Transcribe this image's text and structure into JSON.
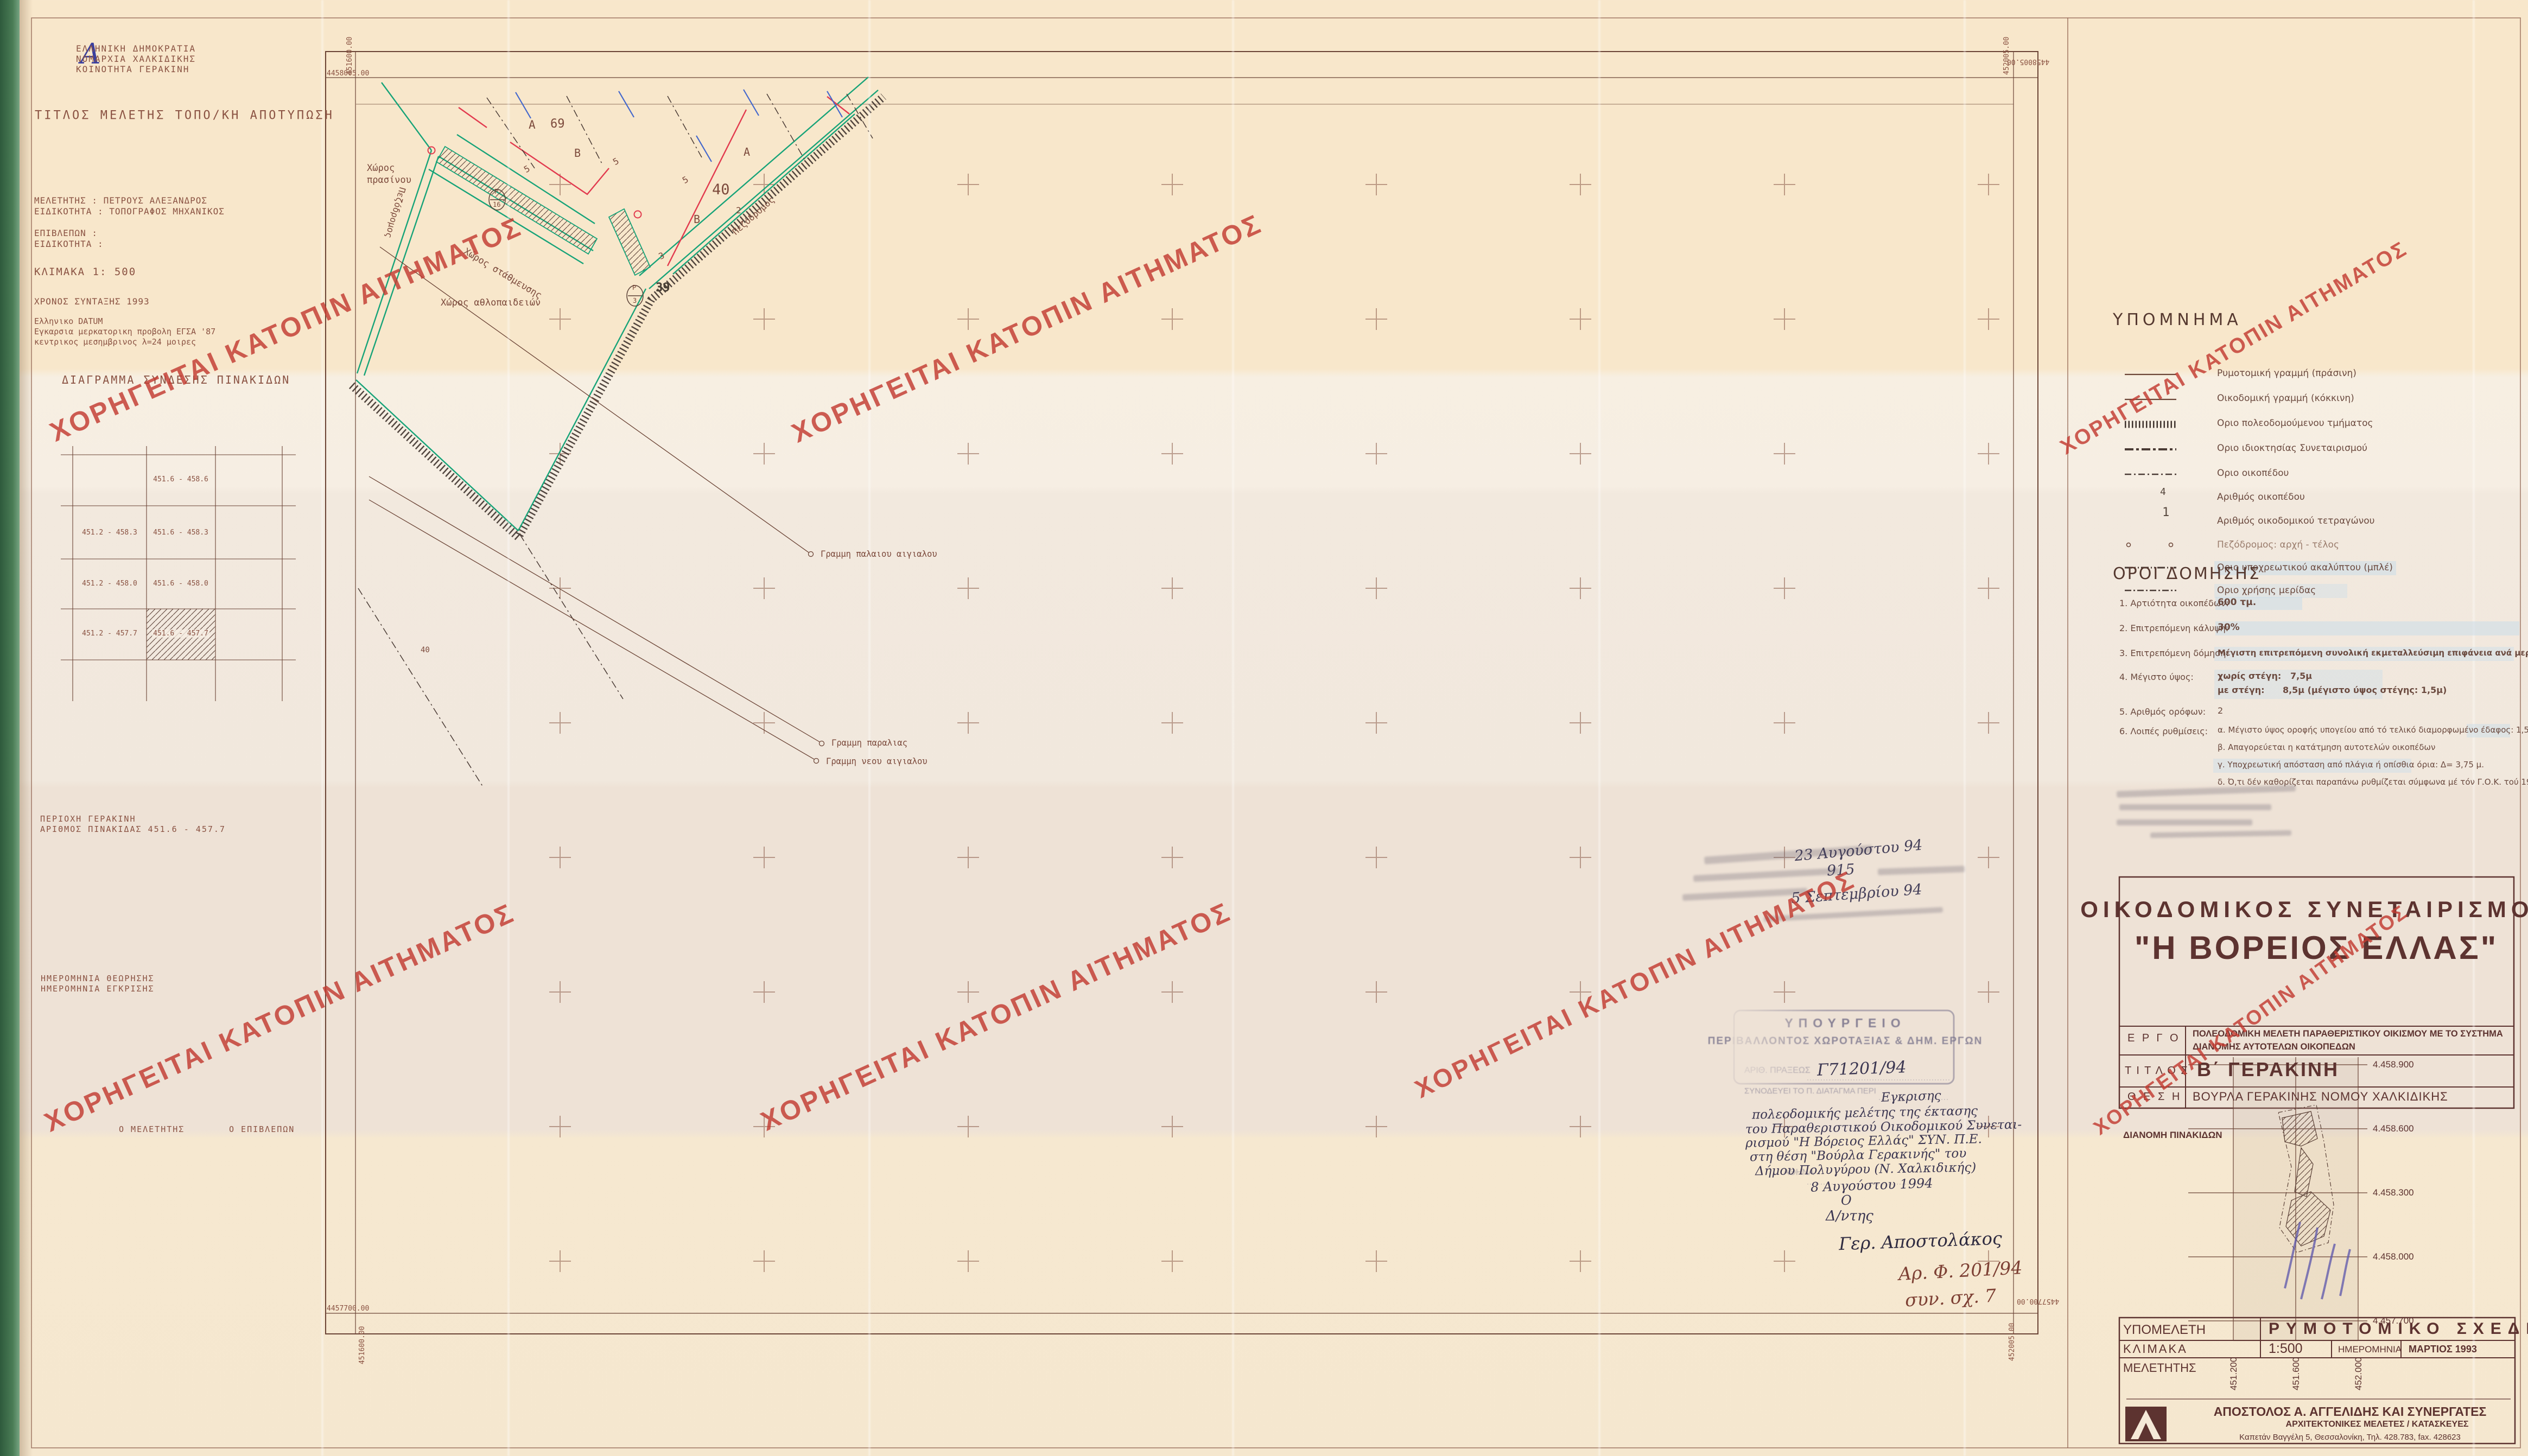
{
  "watermark": {
    "text": "ΧΟΡΗΓΕΙΤΑΙ ΚΑΤΟΠΙΝ ΑΙΤΗΜΑΤΟΣ",
    "color": "#c23a31"
  },
  "corner_note": "Α",
  "agency": {
    "line1": "ΕΛΛΗΝΙΚΗ ΔΗΜΟΚΡΑΤΙΑ",
    "line2": "ΝΟΜΑΡΧΙΑ ΧΑΛΚΙΔΙΚΗΣ",
    "line3": "ΚΟΙΝΟΤΗΤΑ ΓΕΡΑΚΙΝΗ"
  },
  "study": {
    "title_line": "ΤΙΤΛΟΣ ΜΕΛΕΤΗΣ ΤΟΠΟ/ΚΗ ΑΠΟΤΥΠΩΣΗ",
    "meletitis": "ΜΕΛΕΤΗΤΗΣ : ΠΕΤΡΟΥΣ ΑΛΕΞΑΝΔΡΟΣ",
    "eidikotita": "ΕΙΔΙΚΟΤΗΤΑ : ΤΟΠΟΓΡΑΦΟΣ ΜΗΧΑΝΙΚΟΣ",
    "epivlepon": "ΕΠΙΒΛΕΠΩΝ :",
    "eidikotita2": "ΕΙΔΙΚΟΤΗΤΑ :",
    "klimaka": "ΚΛΙΜΑΚΑ 1: 500",
    "xronos": "ΧΡΟΝΟΣ ΣΥΝΤΑΞΗΣ 1993",
    "datum1": "Ελληνικο DATUM",
    "datum2": "Εγκαρσια μερκατορικη προβολη ΕΓΣΑ '87",
    "datum3": "κεντρικος μεσημβρινος λ=24 μοιρες"
  },
  "diagram": {
    "title": "ΔΙΑΓΡΑΜΜΑ ΣΥΝΔΕΣΗΣ ΠΙΝΑΚΙΔΩΝ",
    "r1c2": "451.6 - 458.6",
    "r2c1": "451.2 - 458.3",
    "r2c2": "451.6 - 458.3",
    "r3c1": "451.2 - 458.0",
    "r3c2": "451.6 - 458.0",
    "r4c1": "451.2 - 457.7",
    "r4c2": "451.6 - 457.7"
  },
  "area": {
    "perioxi": "ΠΕΡΙΟΧΗ ΓΕΡΑΚΙΝΗ",
    "pinakida": "ΑΡΙΘΜΟΣ ΠΙΝΑΚΙΔΑΣ 451.6 - 457.7",
    "theorisis": "ΗΜΕΡΟΜΗΝΙΑ ΘΕΩΡΗΣΗΣ",
    "egrisis": "ΗΜΕΡΟΜΗΝΙΑ ΕΓΚΡΙΣΗΣ",
    "o_meletitis": "Ο ΜΕΛΕΤΗΤΗΣ",
    "o_epivlepon": "Ο ΕΠΙΒΛΕΠΩΝ"
  },
  "map": {
    "n_top": "4458005.00",
    "e_left": "451600.00",
    "n_bottom": "4457700.00",
    "e_right": "452005.00",
    "labels": {
      "green1": "Χώρος",
      "green2": "πρασίνου",
      "parking": "Χώρος στάθμευσης",
      "sports": "Χώρος αθλοπαιδειών",
      "pedestrian": "Πεζόδρομος",
      "old_shore": "Γραμμη παλαιου αιγιαλου",
      "beach": "Γραμμη παραλιας",
      "new_shore": "Γραμμη νεου αιγιαλου",
      "blockA": "Α",
      "block69": "69",
      "blockB": "Β",
      "n5": "5",
      "n2": "2",
      "n3": "3",
      "n39": "39",
      "n40": "40",
      "p": "P",
      "p16": "16",
      "p3": "3",
      "small40": "40"
    },
    "handnote1": "Αρ. Φ. 201/94",
    "handnote2": "συν. σχ. 7"
  },
  "legend": {
    "title": "ΥΠΟΜΝΗΜΑ",
    "items": [
      {
        "label": "Ρυμοτομική γραμμή (πράσινη)"
      },
      {
        "label": "Οικοδομική γραμμή (κόκκινη)"
      },
      {
        "label": "Οριο πολεοδομούμενου τμήματος"
      },
      {
        "label": "Οριο ιδιοκτησίας Συνεταιρισμού"
      },
      {
        "label": "Οριο οικοπέδου"
      },
      {
        "label": "Αριθμός οικοπέδου",
        "symbol": "4"
      },
      {
        "label": "Αριθμός οικοδομικού τετραγώνου",
        "symbol": "1"
      },
      {
        "label": "Πεζόδρομος: αρχή - τέλος"
      },
      {
        "label": "Οριο υποχρεωτικού ακαλύπτου (μπλέ)"
      },
      {
        "label": "Οριο χρήσης μερίδας"
      }
    ]
  },
  "oroi": {
    "title": "ΟΡΟΙ ΔΟΜΗΣΗΣ",
    "rows": [
      {
        "label": "1.  Αρτιότητα οικοπέδων:",
        "value": "600 τμ."
      },
      {
        "label": "2.  Επιτρεπόμενη κάλυψη:",
        "value": "30%"
      },
      {
        "label": "3.  Επιτρεπόμενη δόμηση:",
        "value": "Μέγιστη επιτρεπόμενη συνολική εκμεταλλεύσιμη επιφάνεια ανά μερίδα: 120 μ2"
      },
      {
        "label": "4.  Μέγιστο ύψος:",
        "value": "χωρίς στέγη:   7,5μ",
        "value2": "με στέγη:      8,5μ (μέγιστο ύψος στέγης: 1,5μ)"
      },
      {
        "label": "5.  Αριθμός ορόφων:",
        "value": "2"
      },
      {
        "label": "6.  Λοιπές ρυθμίσεις:",
        "value": "α. Μέγιστο ύψος οροφής υπογείου από τό τελικό διαμορφωμένο έδαφος: 1,5μ",
        "value2": "β. Απαγορεύεται η κατάτμηση αυτοτελών οικοπέδων",
        "value3": "γ. Υποχρεωτική απόσταση από πλάγια ή οπίσθια όρια: Δ= 3,75 μ.",
        "value4": "δ. Ό,τι δέν καθορίζεται παραπάνω ρυθμίζεται σύμφωνα μέ τόν Γ.Ο.Κ. τού 1985"
      }
    ]
  },
  "coop": {
    "line1": "ΟΙΚΟΔΟΜΙΚΟΣ ΣΥΝΕΤΑΙΡΙΣΜΟΣ",
    "line2": "\"Η ΒΟΡΕΙΟΣ ΕΛΛΑΣ\"",
    "ergo_label": "Ε Ρ Γ Ο",
    "ergo1": "ΠΟΛΕΟΔΟΜΙΚΗ ΜΕΛΕΤΗ ΠΑΡΑΘΕΡΙΣΤΙΚΟΥ ΟΙΚΙΣΜΟΥ ΜΕ ΤΟ ΣΥΣΤΗΜΑ",
    "ergo2": "ΔΙΑΝΟΜΗΣ ΑΥΤΟΤΕΛΩΝ ΟΙΚΟΠΕΔΩΝ",
    "titlos_label": "Τ Ι Τ Λ Ο Σ",
    "titlos": "Β΄ ΓΕΡΑΚΙΝΗ",
    "thesi_label": "Θ Ε Σ Η",
    "thesi": "ΒΟΥΡΛΑ ΓΕΡΑΚΙΝΗΣ ΝΟΜΟΥ ΧΑΛΚΙΔΙΚΗΣ"
  },
  "keymap": {
    "title": "ΔΙΑΝΟΜΗ ΠΙΝΑΚΙΔΩΝ",
    "y_labels": [
      "4.458.900",
      "4.458.600",
      "4.458.300",
      "4.458.000",
      "4.457.700"
    ],
    "x_labels": [
      "451.200",
      "451.600",
      "452.000"
    ]
  },
  "titleblock": {
    "ypomeleti_label": "ΥΠΟΜΕΛΕΤΗ",
    "ypomeleti": "ΡΥΜΟΤΟΜΙΚΟ ΣΧΕΔΙΟ",
    "klimaka_label": "ΚΛΙΜΑΚΑ",
    "klimaka": "1:500",
    "date_label": "ΗΜΕΡΟΜΗΝΙΑ",
    "date": "ΜΑΡΤΙΟΣ 1993",
    "meletitis_label": "ΜΕΛΕΤΗΤΗΣ",
    "firm": "ΑΠΟΣΤΟΛΟΣ Α. ΑΓΓΕΛΙΔΗΣ ΚΑΙ ΣΥΝΕΡΓΑΤΕΣ",
    "firm2": "ΑΡΧΙΤΕΚΤΟΝΙΚΕΣ ΜΕΛΕΤΕΣ / ΚΑΤΑΣΚΕΥΕΣ",
    "firm3": "Καπετάν Βαγγέλη 5, Θεσσαλονίκη, Τηλ. 428.783, fax. 428623"
  },
  "stamp": {
    "l1": "ΥΠΟΥΡΓΕΙΟ",
    "l2": "ΠΕΡΙΒΑΛΛΟΝΤΟΣ ΧΩΡΟΤΑΞΙΑΣ & ΔΗΜ. ΕΡΓΩΝ",
    "l3": "ΑΡΙΘ. ΠΡΑΞΕΩΣ",
    "num": "Γ71201/94",
    "l4": "ΣΥΝΟΔΕΥΕΙ ΤΟ Π. ΔΙΑΤΑΓΜΑ ΠΕΡΙ",
    "athina": "ΑΘΗΝΑ",
    "hw1": "Εγκρισης",
    "hw2": "πολεοδομικής μελέτης της έκτασης",
    "hw3": "του Παραθεριστικού Οικοδομικού Συνεται-",
    "hw4": "ρισμού \"Η Βόρειος Ελλάς\" ΣΥΝ. Π.Ε.",
    "hw5": "στη θέση \"Βούρλα Γερακινής\" του",
    "hw6": "Δήμου Πολυγύρου (Ν. Χαλκιδικής)",
    "date": "8 Αυγούστου 1994",
    "o": "Ο",
    "dntis": "Δ/ντης",
    "signature": "Γερ. Αποστολάκος"
  },
  "notes": {
    "date1": "23 Αυγούστου 94",
    "num": "915",
    "date2": "5 Σεπτεμβρίου 94"
  }
}
